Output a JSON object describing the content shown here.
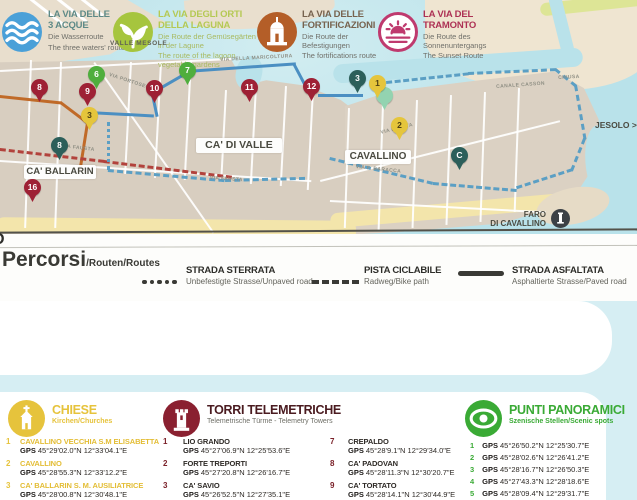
{
  "map": {
    "labels": {
      "valle_mesole": "VALLE MESOLE",
      "ca_di_valle": "CA' DI VALLE",
      "ca_ballarin": "CA' BALLARIN",
      "cavallino": "CAVALLINO",
      "jesolo": "JESOLO >",
      "faro_line1": "FARO",
      "faro_line2": "DI CAVALLINO"
    },
    "streets": [
      "VIA FAUSTA",
      "VIA FAUSTA",
      "VIA FAUSTA",
      "VIA DELLA MARICOLTURA",
      "CANALE CASSON",
      "CHIUSA",
      "VIA F. BARACCA",
      "VIA PORTOSECCO"
    ],
    "pins": [
      {
        "label": "8",
        "color": "#9e2135"
      },
      {
        "label": "6",
        "color": "#4fae3d"
      },
      {
        "label": "9",
        "color": "#9e2135"
      },
      {
        "label": "3",
        "color": "#e5c53c"
      },
      {
        "label": "10",
        "color": "#9e2135"
      },
      {
        "label": "7",
        "color": "#4fae3d"
      },
      {
        "label": "11",
        "color": "#9e2135"
      },
      {
        "label": "12",
        "color": "#9e2135"
      },
      {
        "label": "8",
        "color": "#2c5f5a"
      },
      {
        "label": "16",
        "color": "#9e2135"
      },
      {
        "label": "3",
        "color": "#2c5f5a"
      },
      {
        "label": "1",
        "color": "#e5c53c"
      },
      {
        "label": "",
        "color": "#93d3b0"
      },
      {
        "label": "2",
        "color": "#e5c53c"
      },
      {
        "label": "C",
        "color": "#2c5f5a"
      }
    ]
  },
  "legend": {
    "title_main": "Percorsi",
    "title_rest": "/Routen/Routes",
    "cut_glyph": "D",
    "items": [
      {
        "name": "STRADA STERRATA",
        "sub": "Unbefestigte Strasse/Unpaved road",
        "style": "dotted"
      },
      {
        "name": "PISTA CICLABILE",
        "sub": "Radweg/Bike path",
        "style": "dashed"
      },
      {
        "name": "STRADA ASFALTATA",
        "sub": "Asphaltierte Strasse/Paved road",
        "style": "solid"
      }
    ]
  },
  "routes": [
    {
      "line1": "LA VIA DELLE",
      "line2": "3 ACQUE",
      "de": "Die Wasserroute",
      "en": "The three waters' route",
      "icon": "waves-icon",
      "circle_color": "#4aa0d8",
      "title_color": "#5e8a87"
    },
    {
      "line1": "LA VIA DEGLI ORTI",
      "line2": "DELLA LAGUNA",
      "de": "Die Route der Gemüsegärten in der Lagune",
      "en": "The route of the lagoon vegetable gardens",
      "icon": "plant-icon",
      "circle_color": "#a6c53e",
      "title_color": "#b5c954"
    },
    {
      "line1": "LA VIA DELLE",
      "line2": "FORTIFICAZIONI",
      "de": "Die Route der Befestigungen",
      "en": "The fortifications route",
      "icon": "fort-icon",
      "circle_color": "#b45e28",
      "title_color": "#77634f"
    },
    {
      "line1": "LA VIA DEL",
      "line2": "TRAMONTO",
      "de": "Die Route des Sonnenuntergangs",
      "en": "The Sunset Route",
      "icon": "sunset-icon",
      "circle_color": "#bf3a6e",
      "title_color": "#ad3154"
    }
  ],
  "sections": {
    "gps_label": "GPS",
    "chiese": {
      "title": "CHIESE",
      "sub": "Kirchen/Churches",
      "color": "#e6c33c",
      "items": [
        {
          "n": "1",
          "name": "CAVALLINO VECCHIA S.M ELISABETTA",
          "gps": "45°29'02.0\"N 12°33'04.1\"E"
        },
        {
          "n": "2",
          "name": "CAVALLINO",
          "gps": "45°28'55.3\"N 12°33'12.2\"E"
        },
        {
          "n": "3",
          "name": "CA' BALLARIN S. M. AUSILIATRICE",
          "gps": "45°28'00.8\"N 12°30'48.1\"E"
        }
      ]
    },
    "torri": {
      "title": "TORRI TELEMETRICHE",
      "sub": "Telemetrische Türme - Telemetry Towers",
      "color": "#8a2030",
      "items_left": [
        {
          "n": "1",
          "name": "LIO GRANDO",
          "gps": "45°27'06.9\"N 12°25'53.6\"E"
        },
        {
          "n": "2",
          "name": "FORTE TREPORTI",
          "gps": "45°27'20.8\"N 12°26'16.7\"E"
        },
        {
          "n": "3",
          "name": "CA' SAVIO",
          "gps": "45°26'52.5\"N 12°27'35.1\"E"
        }
      ],
      "items_right": [
        {
          "n": "7",
          "name": "CREPALDO",
          "gps": "45°28'9.1\"N 12°29'34.0\"E"
        },
        {
          "n": "8",
          "name": "CA' PADOVAN",
          "gps": "45°28'11.3\"N 12°30'20.7\"E"
        },
        {
          "n": "9",
          "name": "CA' TORTATO",
          "gps": "45°28'14.1\"N 12°30'44.9\"E"
        }
      ]
    },
    "punti": {
      "title": "PUNTI PANORAMICI",
      "sub": "Szenische Stellen/Scenic spots",
      "color": "#3aaa35",
      "items": [
        {
          "n": "1",
          "gps": "45°26'50.2\"N 12°25'30.7\"E"
        },
        {
          "n": "2",
          "gps": "45°28'02.6\"N 12°26'41.2\"E"
        },
        {
          "n": "3",
          "gps": "45°28'16.7\"N 12°26'50.3\"E"
        },
        {
          "n": "4",
          "gps": "45°27'43.3\"N 12°28'18.6\"E"
        },
        {
          "n": "5",
          "gps": "45°28'09.4\"N 12°29'31.7\"E"
        }
      ]
    }
  }
}
